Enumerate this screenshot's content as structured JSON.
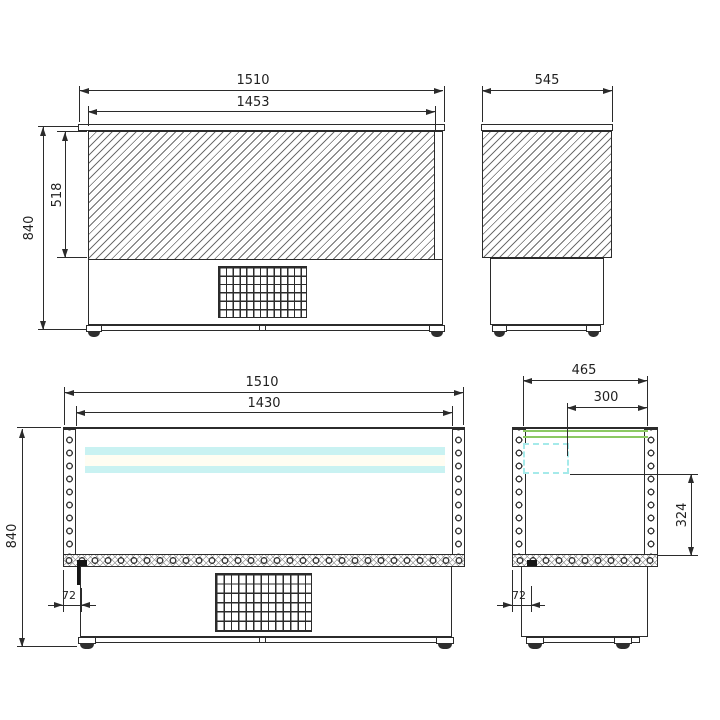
{
  "drawing": {
    "type": "technical-dimension-drawing",
    "subject": "refrigerated saladette counter",
    "units": "mm",
    "views": {
      "front": {
        "width_top": "1510",
        "width_panel": "1453",
        "height_panel": "518",
        "height_total": "840"
      },
      "side": {
        "depth": "545"
      },
      "front_section": {
        "width_top": "1510",
        "width_inner": "1430",
        "height_total": "840",
        "offset_drain": "72"
      },
      "side_section": {
        "depth_top": "465",
        "depth_opening": "300",
        "height_inner": "324",
        "offset_drain": "72"
      }
    },
    "colors": {
      "line": "#2b2b2b",
      "glass_band_cyan": "#c9f2f2",
      "worktop_green": "#8cc963",
      "pan_dash_cyan": "#a5eaea"
    }
  }
}
